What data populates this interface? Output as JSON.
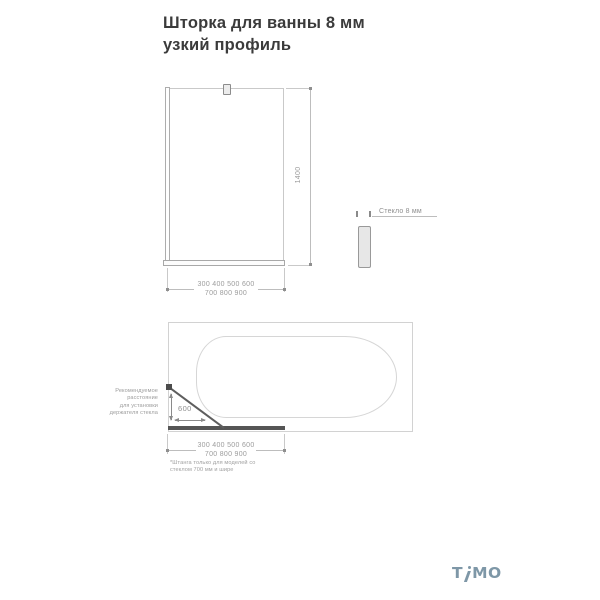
{
  "title": "Шторка для ванны 8 мм узкий профиль",
  "front_view": {
    "height_dim": "1400",
    "width_dim_line1": "300 400 500 600",
    "width_dim_line2": "700 800 900"
  },
  "glass_detail": {
    "label": "Стекло 8 мм"
  },
  "top_view": {
    "holder_note": [
      "Рекомендуемое",
      "расстояние",
      "для установки",
      "держателя стекла"
    ],
    "rod_dim": "600",
    "width_dim_line1": "300 400 500 600",
    "width_dim_line2": "700 800 900",
    "footnote": [
      "*Штанга только для моделей со",
      "стеклом 700 мм и шире"
    ]
  },
  "logo": {
    "part1": "T",
    "part2": "MO"
  },
  "colors": {
    "title_text": "#3b3b3b",
    "dim_text": "#9c9c9c",
    "line_light": "#c9c9c9",
    "line_dark": "#555555",
    "logo": "#7e97a7"
  }
}
